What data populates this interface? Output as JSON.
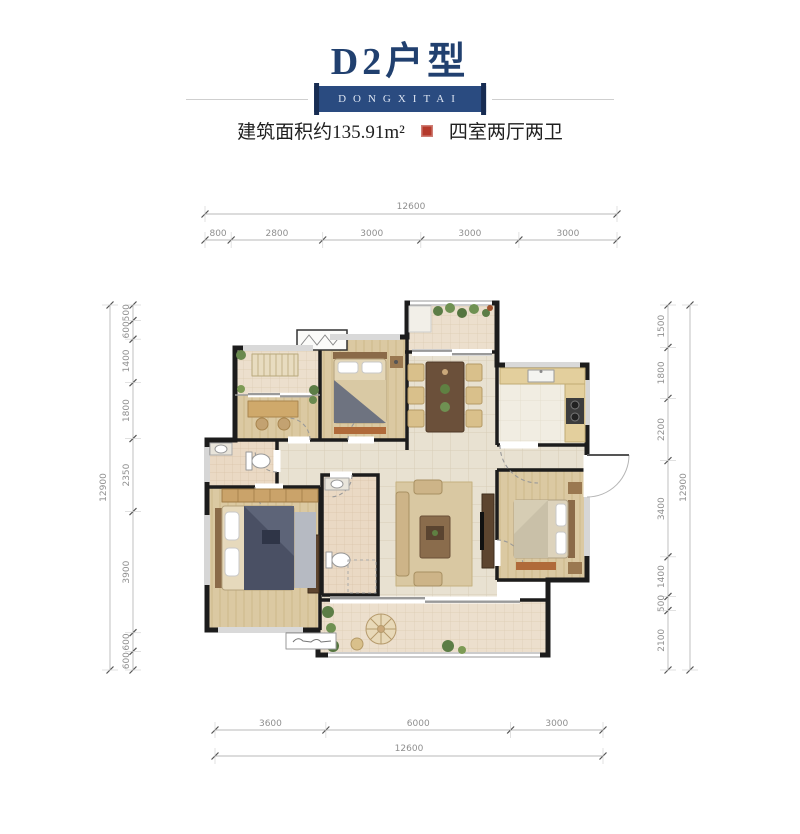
{
  "header": {
    "title": "D2户型",
    "banner_text": "DONGXITAI",
    "area_text": "建筑面积约135.91m²",
    "rooms_text": "四室两厅两卫",
    "colors": {
      "title": "#21406f",
      "banner_bg": "#2a4b80",
      "seal": "#b5392b"
    }
  },
  "dimensions": {
    "color": "#8f8f8f",
    "top": {
      "overall": "12600",
      "segments": [
        "800",
        "2800",
        "3000",
        "3000",
        "3000"
      ]
    },
    "bottom": {
      "overall": "12600",
      "segments": [
        "3600",
        "6000",
        "3000"
      ]
    },
    "left": {
      "overall": "12900",
      "segments": [
        "500",
        "600",
        "1400",
        "1800",
        "2350",
        "3900",
        "600",
        "600"
      ]
    },
    "right": {
      "overall": "12900",
      "segments": [
        "1500",
        "1800",
        "2200",
        "3400",
        "1400",
        "500",
        "2100"
      ]
    }
  }
}
